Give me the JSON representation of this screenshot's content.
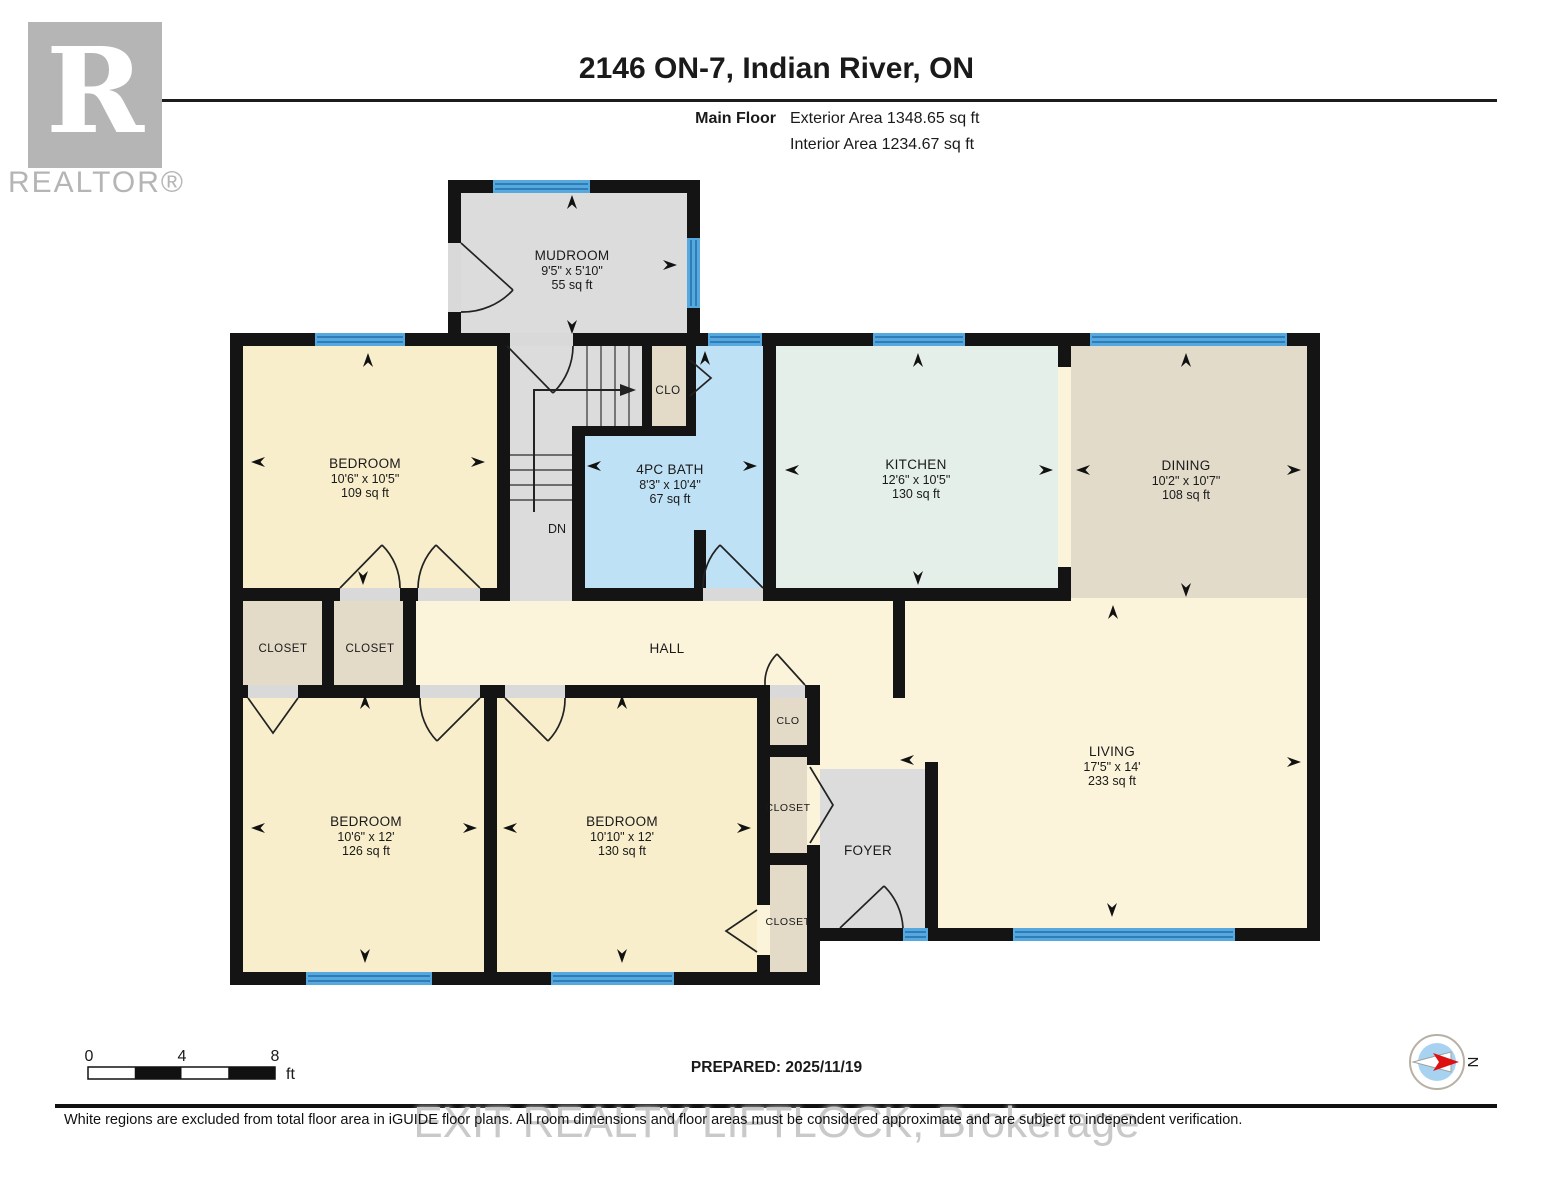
{
  "header": {
    "title": "2146 ON-7, Indian River, ON",
    "floor_label": "Main Floor",
    "exterior_area": "Exterior Area 1348.65 sq ft",
    "interior_area": "Interior Area 1234.67 sq ft"
  },
  "branding": {
    "logo_letter": "R",
    "realtor_wordmark": "REALTOR®",
    "watermark": "EXIT REALTY LIFTLOCK, Brokerage"
  },
  "rooms": {
    "mudroom": {
      "name": "MUDROOM",
      "dims": "9'5\" x 5'10\"",
      "area": "55 sq ft"
    },
    "bedroom_top": {
      "name": "BEDROOM",
      "dims": "10'6\" x 10'5\"",
      "area": "109 sq ft"
    },
    "bath": {
      "name": "4PC BATH",
      "dims": "8'3\" x 10'4\"",
      "area": "67 sq ft"
    },
    "kitchen": {
      "name": "KITCHEN",
      "dims": "12'6\" x 10'5\"",
      "area": "130 sq ft"
    },
    "dining": {
      "name": "DINING",
      "dims": "10'2\" x 10'7\"",
      "area": "108 sq ft"
    },
    "bedroom_left": {
      "name": "BEDROOM",
      "dims": "10'6\" x 12'",
      "area": "126 sq ft"
    },
    "bedroom_mid": {
      "name": "BEDROOM",
      "dims": "10'10\" x 12'",
      "area": "130 sq ft"
    },
    "living": {
      "name": "LIVING",
      "dims": "17'5\" x 14'",
      "area": "233 sq ft"
    }
  },
  "labels": {
    "hall": "HALL",
    "foyer": "FOYER",
    "closet": "CLOSET",
    "clo": "CLO",
    "down": "DN"
  },
  "scale_bar": {
    "tick_0": "0",
    "tick_mid": "4",
    "tick_end": "8",
    "unit": "ft"
  },
  "compass": {
    "north": "N"
  },
  "footer": {
    "prepared": "PREPARED: 2025/11/19",
    "disclaimer": "White regions are excluded from total floor area in iGUIDE floor plans. All room dimensions and floor areas must be considered approximate and are subject to independent verification."
  },
  "palette": {
    "wall": "#141414",
    "win": "#55a9de",
    "winline": "#246ea8",
    "bedroom": "#f8eecb",
    "hallc": "#fcf4da",
    "bath": "#bfe1f5",
    "kitchen": "#e4efe9",
    "dining": "#e2dbc9",
    "closet": "#e3dac7",
    "greyfloor": "#dcdcdc",
    "thresh": "#d9d9d9",
    "logogrey": "#b5b5b5"
  }
}
